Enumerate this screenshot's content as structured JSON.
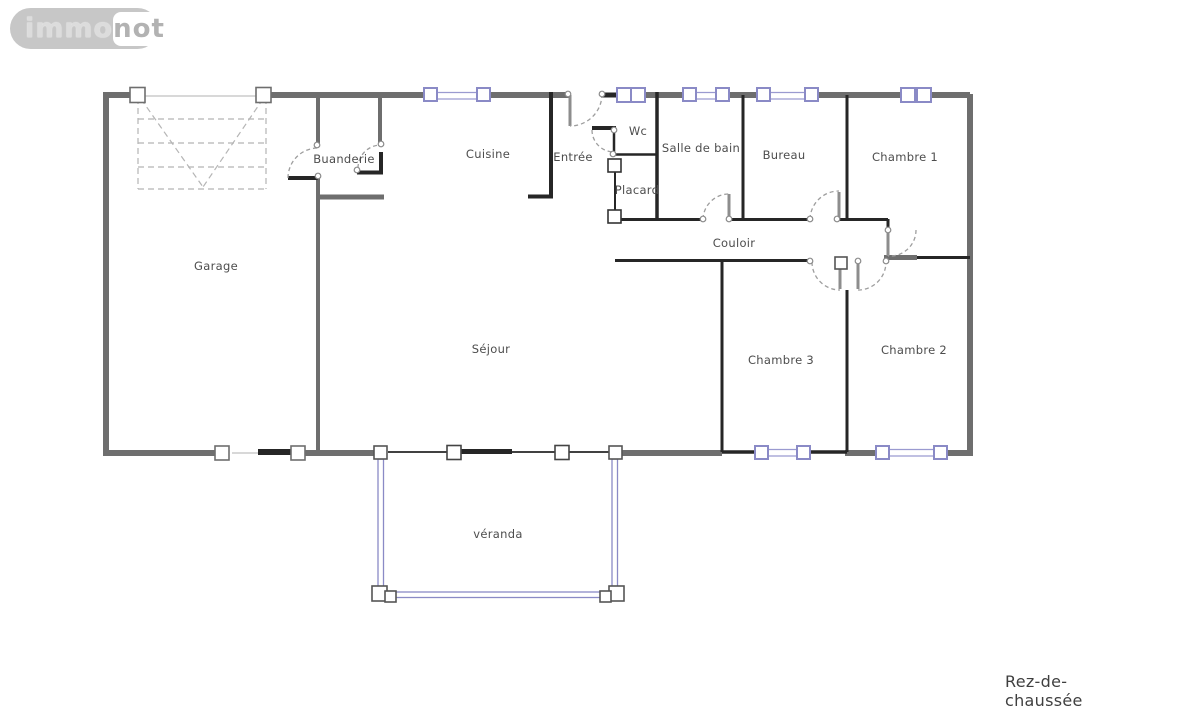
{
  "logo": {
    "immo": "immo",
    "not": "not"
  },
  "plan": {
    "floor_label": "Rez-de-chaussée",
    "rooms": {
      "garage": "Garage",
      "buanderie": "Buanderie",
      "cuisine": "Cuisine",
      "entree": "Entrée",
      "wc": "Wc",
      "placard": "Placard",
      "salle_de_bain": "Salle de bain",
      "bureau": "Bureau",
      "chambre1": "Chambre 1",
      "couloir": "Couloir",
      "sejour": "Séjour",
      "chambre3": "Chambre 3",
      "chambre2": "Chambre 2",
      "veranda": "véranda"
    },
    "colors": {
      "exterior_wall": "#6e6e6e",
      "partition_wall": "#262626",
      "window_frame": "#8a8ac6",
      "door_arc": "#9e9e9e",
      "label_text": "#4d4d4d"
    }
  }
}
